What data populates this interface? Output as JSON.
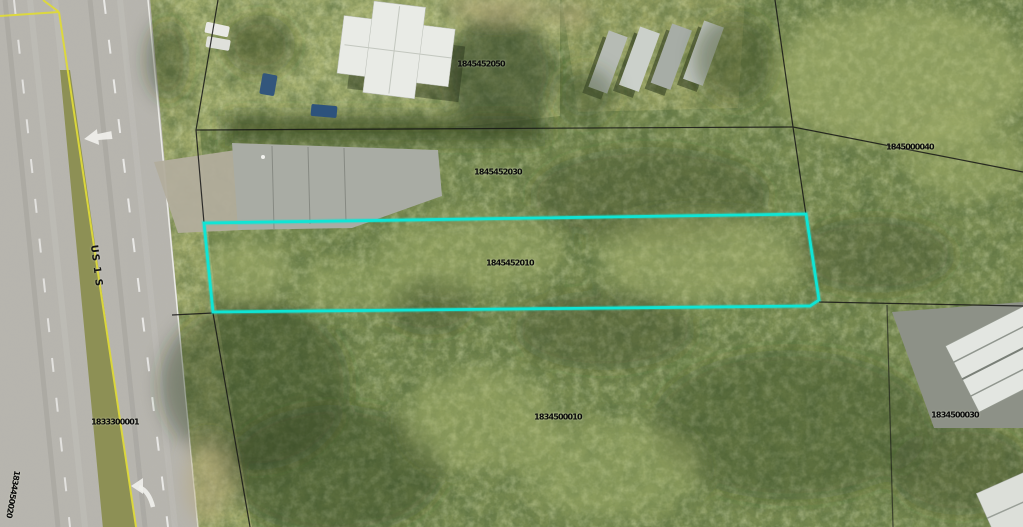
{
  "map": {
    "road": {
      "label": "US 1 S"
    },
    "selected_parcel": {
      "id": "1845452010",
      "highlight_color": "#0FE5D5"
    },
    "parcel_labels": [
      {
        "id": "1845452050"
      },
      {
        "id": "1845452030"
      },
      {
        "id": "1845000040"
      },
      {
        "id": "1845452010"
      },
      {
        "id": "1833300001"
      },
      {
        "id": "1834500010"
      },
      {
        "id": "1834500030"
      },
      {
        "id": "1834450020"
      }
    ],
    "icons": {
      "straight_arrow": "left-arrow-road-marking",
      "turn_arrow": "left-turn-arrow-road-marking"
    },
    "colors": {
      "highlight": "#0FE5D5",
      "boundary": "#161616",
      "road_yellow_line": "#DFDA3A"
    }
  }
}
